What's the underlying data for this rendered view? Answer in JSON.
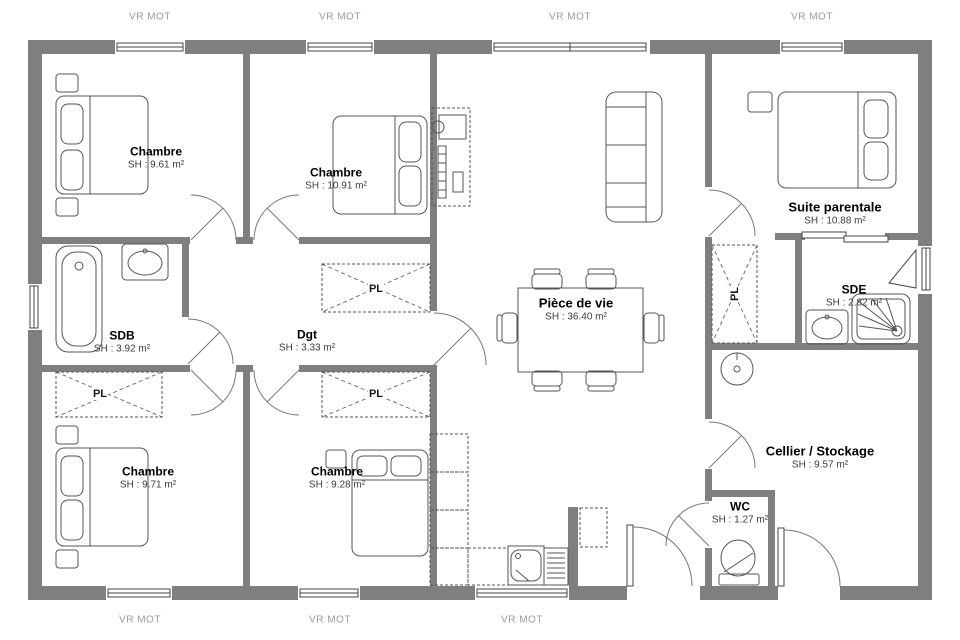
{
  "labels": {
    "vr_mot": "VR MOT",
    "pl": "PL"
  },
  "rooms": [
    {
      "id": "chambre-top-left",
      "name": "Chambre",
      "area": "SH : 9.61 m²"
    },
    {
      "id": "chambre-top-mid",
      "name": "Chambre",
      "area": "SH : 10.91 m²"
    },
    {
      "id": "suite-parentale",
      "name": "Suite parentale",
      "area": "SH : 10.88 m²"
    },
    {
      "id": "sdb",
      "name": "SDB",
      "area": "SH : 3.92 m²"
    },
    {
      "id": "degagement",
      "name": "Dgt",
      "area": "SH : 3.33 m²"
    },
    {
      "id": "piece-de-vie",
      "name": "Pièce de vie",
      "area": "SH : 36.40 m²"
    },
    {
      "id": "sde",
      "name": "SDE",
      "area": "SH : 2.82 m²"
    },
    {
      "id": "chambre-bot-left",
      "name": "Chambre",
      "area": "SH : 9.71 m²"
    },
    {
      "id": "chambre-bot-mid",
      "name": "Chambre",
      "area": "SH : 9.28 m²"
    },
    {
      "id": "cellier",
      "name": "Cellier / Stockage",
      "area": "SH : 9.57 m²"
    },
    {
      "id": "wc",
      "name": "WC",
      "area": "SH : 1.27 m²"
    }
  ],
  "colors": {
    "wall": "#7f7f7f",
    "line": "#555555",
    "window_line": "#444444",
    "door_line": "#777777",
    "name_text": "#000000",
    "area_text": "#3c3c3c",
    "vr_text": "#9b9b9b",
    "background": "#ffffff"
  }
}
